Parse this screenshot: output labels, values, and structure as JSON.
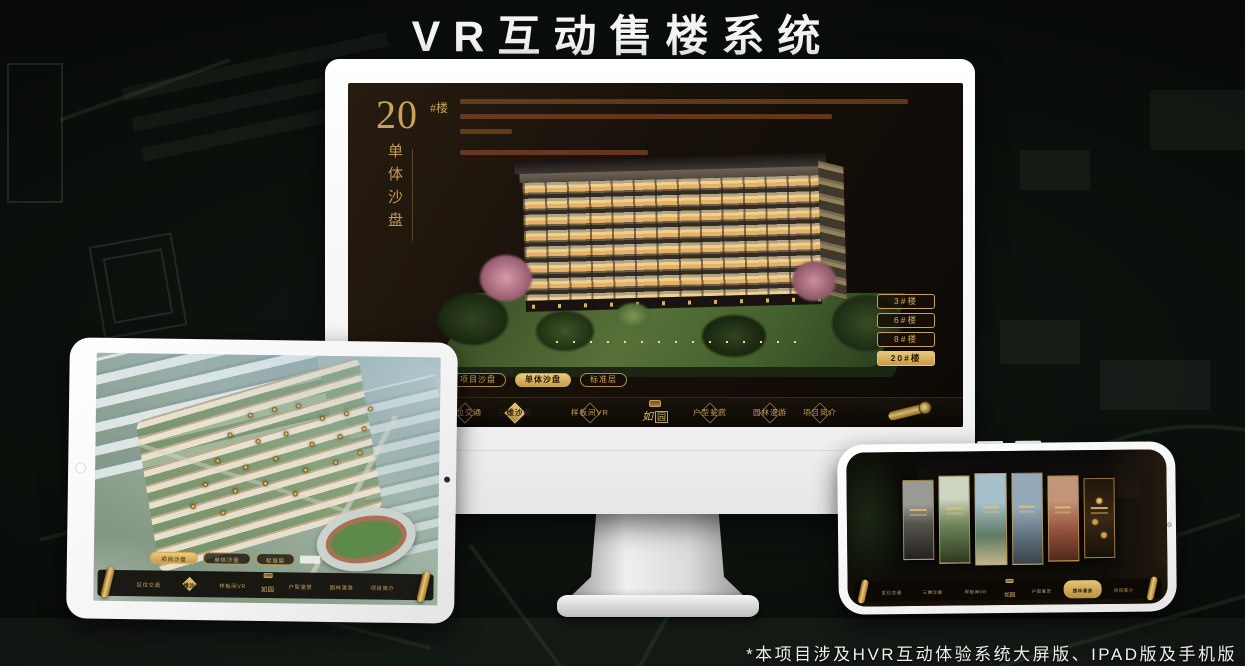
{
  "page": {
    "title": "VR互动售楼系统",
    "footnote": "*本项目涉及HVR互动体验系统大屏版、IPAD版及手机版"
  },
  "colors": {
    "accent_gold": "#c9a25a",
    "screen_background": "#17100a",
    "device_body": "#ffffff"
  },
  "project_nav": {
    "logo_char1": "如",
    "logo_char2": "园",
    "items": [
      "区位交通",
      "三维沙盘",
      "样板间VR",
      "户型鉴赏",
      "园林漫游",
      "项目简介"
    ]
  },
  "view_tabs": [
    "项目沙盘",
    "单体沙盘",
    "标准层"
  ],
  "monitor": {
    "hero_number": "20",
    "hero_suffix": "#楼",
    "hero_subtitle": "单体沙盘",
    "floor_buttons": [
      "3#楼",
      "6#楼",
      "8#楼",
      "20#楼"
    ],
    "active_floor": "20#楼",
    "active_tab": "单体沙盘",
    "active_nav_item": "三维沙盘"
  },
  "tablet": {
    "active_tab": "项目沙盘",
    "active_nav_item": "三维沙盘"
  },
  "phone": {
    "active_nav_item": "园林漫游",
    "gallery_panel_count": 6
  }
}
